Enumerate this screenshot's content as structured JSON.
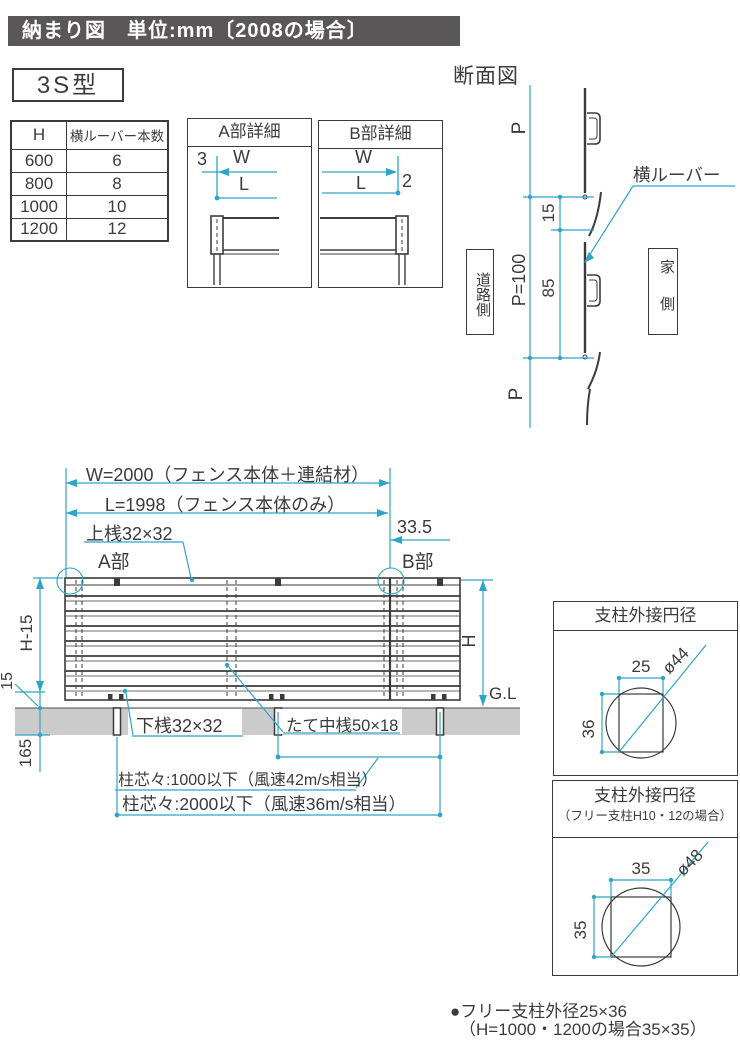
{
  "header": {
    "title": "納まり図　単位:mm〔2008の場合〕"
  },
  "model_label": "3S型",
  "louver_table": {
    "columns": [
      "H",
      "横ルーバー本数"
    ],
    "rows": [
      [
        "600",
        "6"
      ],
      [
        "800",
        "8"
      ],
      [
        "1000",
        "10"
      ],
      [
        "1200",
        "12"
      ]
    ]
  },
  "detail_a": {
    "title": "A部詳細",
    "offset": "3",
    "w": "W",
    "l": "L"
  },
  "detail_b": {
    "title": "B部詳細",
    "offset": "2",
    "w": "W",
    "l": "L"
  },
  "section": {
    "title": "断面図",
    "p_top": "P",
    "p_pitch": "P=100",
    "d15": "15",
    "d85": "85",
    "p_bottom": "P",
    "road_side": "道路側",
    "house_side": "家側",
    "louver_label": "横ルーバー"
  },
  "elevation": {
    "w_dim": "W=2000（フェンス本体＋連結材）",
    "l_dim": "L=1998（フェンス本体のみ）",
    "top_rail": "上桟32×32",
    "offset": "33.5",
    "part_a": "A部",
    "part_b": "B部",
    "h_minus_15": "H-15",
    "d15": "15",
    "d165": "165",
    "h": "H",
    "gl": "G.L",
    "bottom_rail": "下桟32×32",
    "mid_rail": "たて中桟50×18",
    "post_pitch_1": "柱芯々:1000以下（風速42m/s相当）",
    "post_pitch_2": "柱芯々:2000以下（風速36m/s相当）"
  },
  "post_circle_1": {
    "title": "支柱外接円径",
    "w": "25",
    "h": "36",
    "dia": "ø44"
  },
  "post_circle_2": {
    "title": "支柱外接円径",
    "subtitle": "（フリー支柱H10・12の場合）",
    "w": "35",
    "h": "35",
    "dia": "ø48"
  },
  "footnote": {
    "line1": "●フリー支柱外径25×36",
    "line2": "（H=1000・1200の場合35×35）"
  },
  "colors": {
    "dim_line": "#2da5c8",
    "ink": "#3b3b3b",
    "ground": "#cbcbcb",
    "header_bg": "#595757"
  }
}
